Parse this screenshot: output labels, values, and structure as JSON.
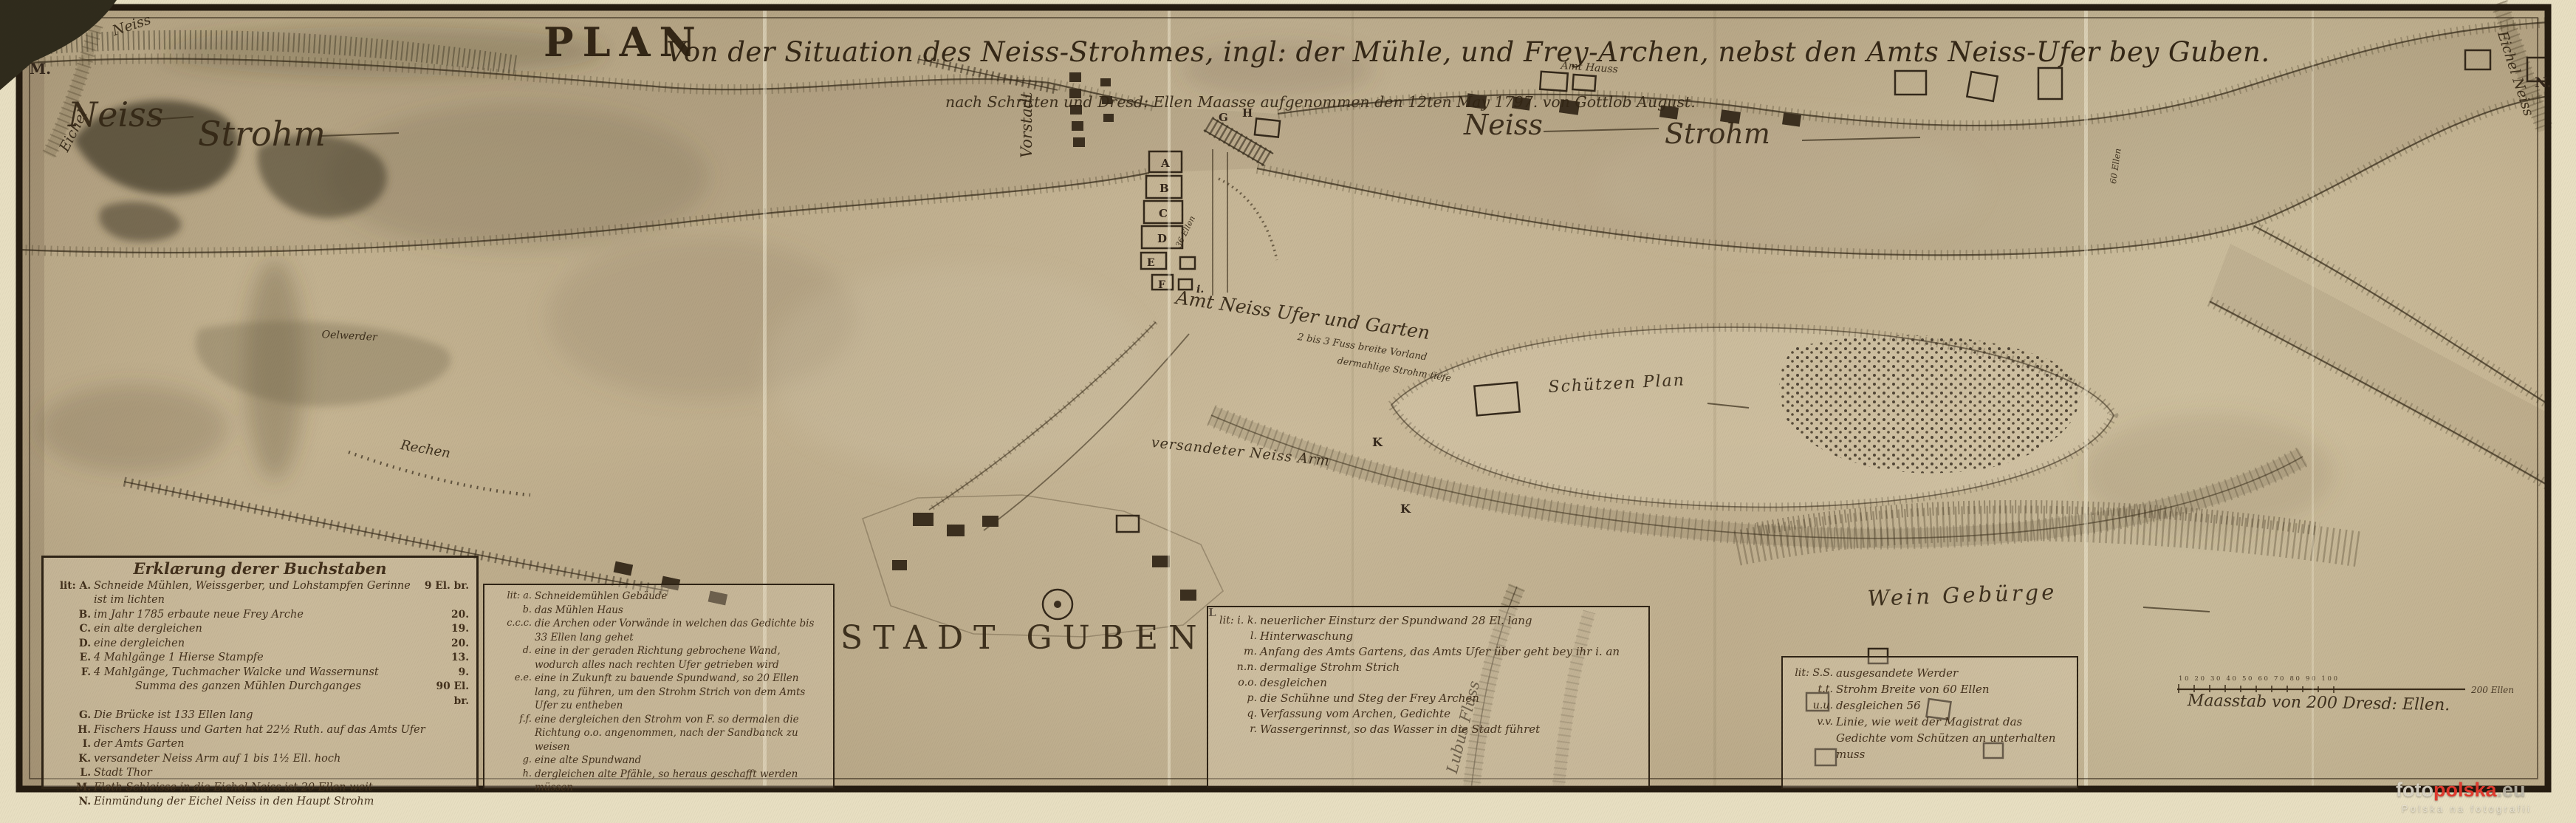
{
  "colors": {
    "paper": "#c8b795",
    "ink": "#3a2c1a",
    "cream": "#e8dfc2",
    "frame": "#241b10",
    "watermark_red": "#e03a2e",
    "watermark_light": "#ddd8c8"
  },
  "title": {
    "lead": "PLAN",
    "main": "Von der Situation des Neiss-Strohmes, ingl: der Mühle, und Frey-Archen, nebst den Amts Neiss-Ufer bey Guben.",
    "subtitle": "nach Schritten und Dresd: Ellen Maasse aufgenommen den 12ten May 1797. von Gottlob August."
  },
  "river_labels": {
    "neiss_left_1": "Neiss",
    "neiss_left_2": "Strohm",
    "neiss_right_1": "Neiss",
    "neiss_right_2": "Strohm",
    "eichel_tl_1": "Eichel",
    "eichel_tl_2": "Neiss",
    "eichel_tr": "Eichel Neiss",
    "lubus": "Lubus Fluss",
    "neiss_arm": "versandeter Neiss Arm"
  },
  "place_labels": {
    "stadt_guben": "STADT GUBEN",
    "vorstadt": "Vorstadt",
    "amts_ufer": "Amt Neiss Ufer und Garten",
    "vorland": "2 bis 3 Fuss breite Vorland",
    "strohm_tiefe": "dermahlige Strohm tiefe",
    "amt_hauss": "Amt Hauss",
    "schuetzen_plan": "Schützen Plan",
    "wein_gebuerge": "Wein Gebürge",
    "rechen": "Rechen",
    "oelwerder": "Oelwerder",
    "ellen_36": "36 Ellen",
    "ellen_60": "60 Ellen"
  },
  "map_letters": [
    {
      "ch": "M."
    },
    {
      "ch": "N."
    },
    {
      "ch": "A"
    },
    {
      "ch": "B"
    },
    {
      "ch": "C"
    },
    {
      "ch": "D"
    },
    {
      "ch": "E"
    },
    {
      "ch": "F"
    },
    {
      "ch": "G"
    },
    {
      "ch": "H"
    },
    {
      "ch": "i."
    },
    {
      "ch": "K"
    },
    {
      "ch": "K"
    },
    {
      "ch": "L"
    }
  ],
  "legend1": {
    "header": "Erklærung derer Buchstaben",
    "entries": [
      {
        "key": "lit: A.",
        "text": "Schneide Mühlen, Weissgerber, und Lohstampfen Gerinne ist im lichten",
        "value": "9 El. br."
      },
      {
        "key": "B.",
        "text": "im Jahr 1785 erbaute neue Frey Arche",
        "value": "20."
      },
      {
        "key": "C.",
        "text": "ein alte dergleichen",
        "value": "19."
      },
      {
        "key": "D.",
        "text": "eine dergleichen",
        "value": "20."
      },
      {
        "key": "E.",
        "text": "4 Mahlgänge 1 Hierse Stampfe",
        "value": "13."
      },
      {
        "key": "F.",
        "text": "4 Mahlgänge, Tuchmacher Walcke und Wassernunst",
        "value": "9."
      },
      {
        "key": "",
        "text": "Summa des ganzen Mühlen Durchganges",
        "value": "90 El. br."
      },
      {
        "key": "G.",
        "text": "Die Brücke ist 133 Ellen lang",
        "value": ""
      },
      {
        "key": "H.",
        "text": "Fischers Hauss und Garten hat 22½ Ruth. auf das Amts Ufer",
        "value": ""
      },
      {
        "key": "I.",
        "text": "der Amts Garten",
        "value": ""
      },
      {
        "key": "K.",
        "text": "versandeter Neiss Arm auf 1 bis 1½ Ell. hoch",
        "value": ""
      },
      {
        "key": "L.",
        "text": "Stadt Thor",
        "value": ""
      },
      {
        "key": "M.",
        "text": "Floth Schleisse in die Eichel Neiss ist 20 Ellen weit",
        "value": ""
      },
      {
        "key": "N.",
        "text": "Einmündung der Eichel Neiss in den Haupt Strohm",
        "value": ""
      }
    ]
  },
  "legend2": {
    "entries": [
      {
        "key": "lit: a.",
        "text": "Schneidemühlen Gebäude"
      },
      {
        "key": "b.",
        "text": "das Mühlen Haus"
      },
      {
        "key": "c.c.c.",
        "text": "die Archen oder Vorwände in welchen das Gedichte bis 33 Ellen lang gehet"
      },
      {
        "key": "d.",
        "text": "eine in der geraden Richtung gebrochene Wand, wodurch alles nach rechten Ufer getrieben wird"
      },
      {
        "key": "e.e.",
        "text": "eine in Zukunft zu bauende Spundwand, so 20 Ellen lang, zu führen, um den Strohm Strich von dem Amts Ufer zu entheben"
      },
      {
        "key": "f.f.",
        "text": "eine dergleichen den Strohm von F. so dermalen die Richtung o.o. angenommen, nach der Sandbanck zu weisen"
      },
      {
        "key": "g.",
        "text": "eine alte Spundwand"
      },
      {
        "key": "h.",
        "text": "dergleichen alte Pfähle, so heraus geschafft werden müssen"
      }
    ]
  },
  "legend3": {
    "entries": [
      {
        "key": "lit: i. k.",
        "text": "neuerlicher Einsturz der Spundwand 28 El. lang"
      },
      {
        "key": "l.",
        "text": "Hinterwaschung"
      },
      {
        "key": "m.",
        "text": "Anfang des Amts Gartens, das Amts Ufer über geht bey ihr i. an"
      },
      {
        "key": "n.n.",
        "text": "dermalige Strohm Strich"
      },
      {
        "key": "o.o.",
        "text": "desgleichen"
      },
      {
        "key": "p.",
        "text": "die Schühne und Steg der Frey Archen"
      },
      {
        "key": "q.",
        "text": "Verfassung vom Archen, Gedichte"
      },
      {
        "key": "r.",
        "text": "Wassergerinnst, so das Wasser in die Stadt führet"
      }
    ]
  },
  "legend4": {
    "entries": [
      {
        "key": "lit: S.S.",
        "text": "ausgesandete Werder"
      },
      {
        "key": "t.t.",
        "text": "Strohm Breite von 60 Ellen"
      },
      {
        "key": "u.u.",
        "text": "desgleichen 56"
      },
      {
        "key": "v.v.",
        "text": "Linie, wie weit der Magistrat das Gedichte vom Schützen an unterhalten muss"
      }
    ]
  },
  "scale": {
    "caption": "Maasstab von 200 Dresd: Ellen.",
    "tick_labels": "10 20 30 40 50 60 70 80 90 100",
    "end_label": "200 Ellen"
  },
  "watermark": {
    "part1": "foto",
    "part2": "polska",
    "part3": ".eu",
    "tagline": "Polska na fotografii"
  }
}
